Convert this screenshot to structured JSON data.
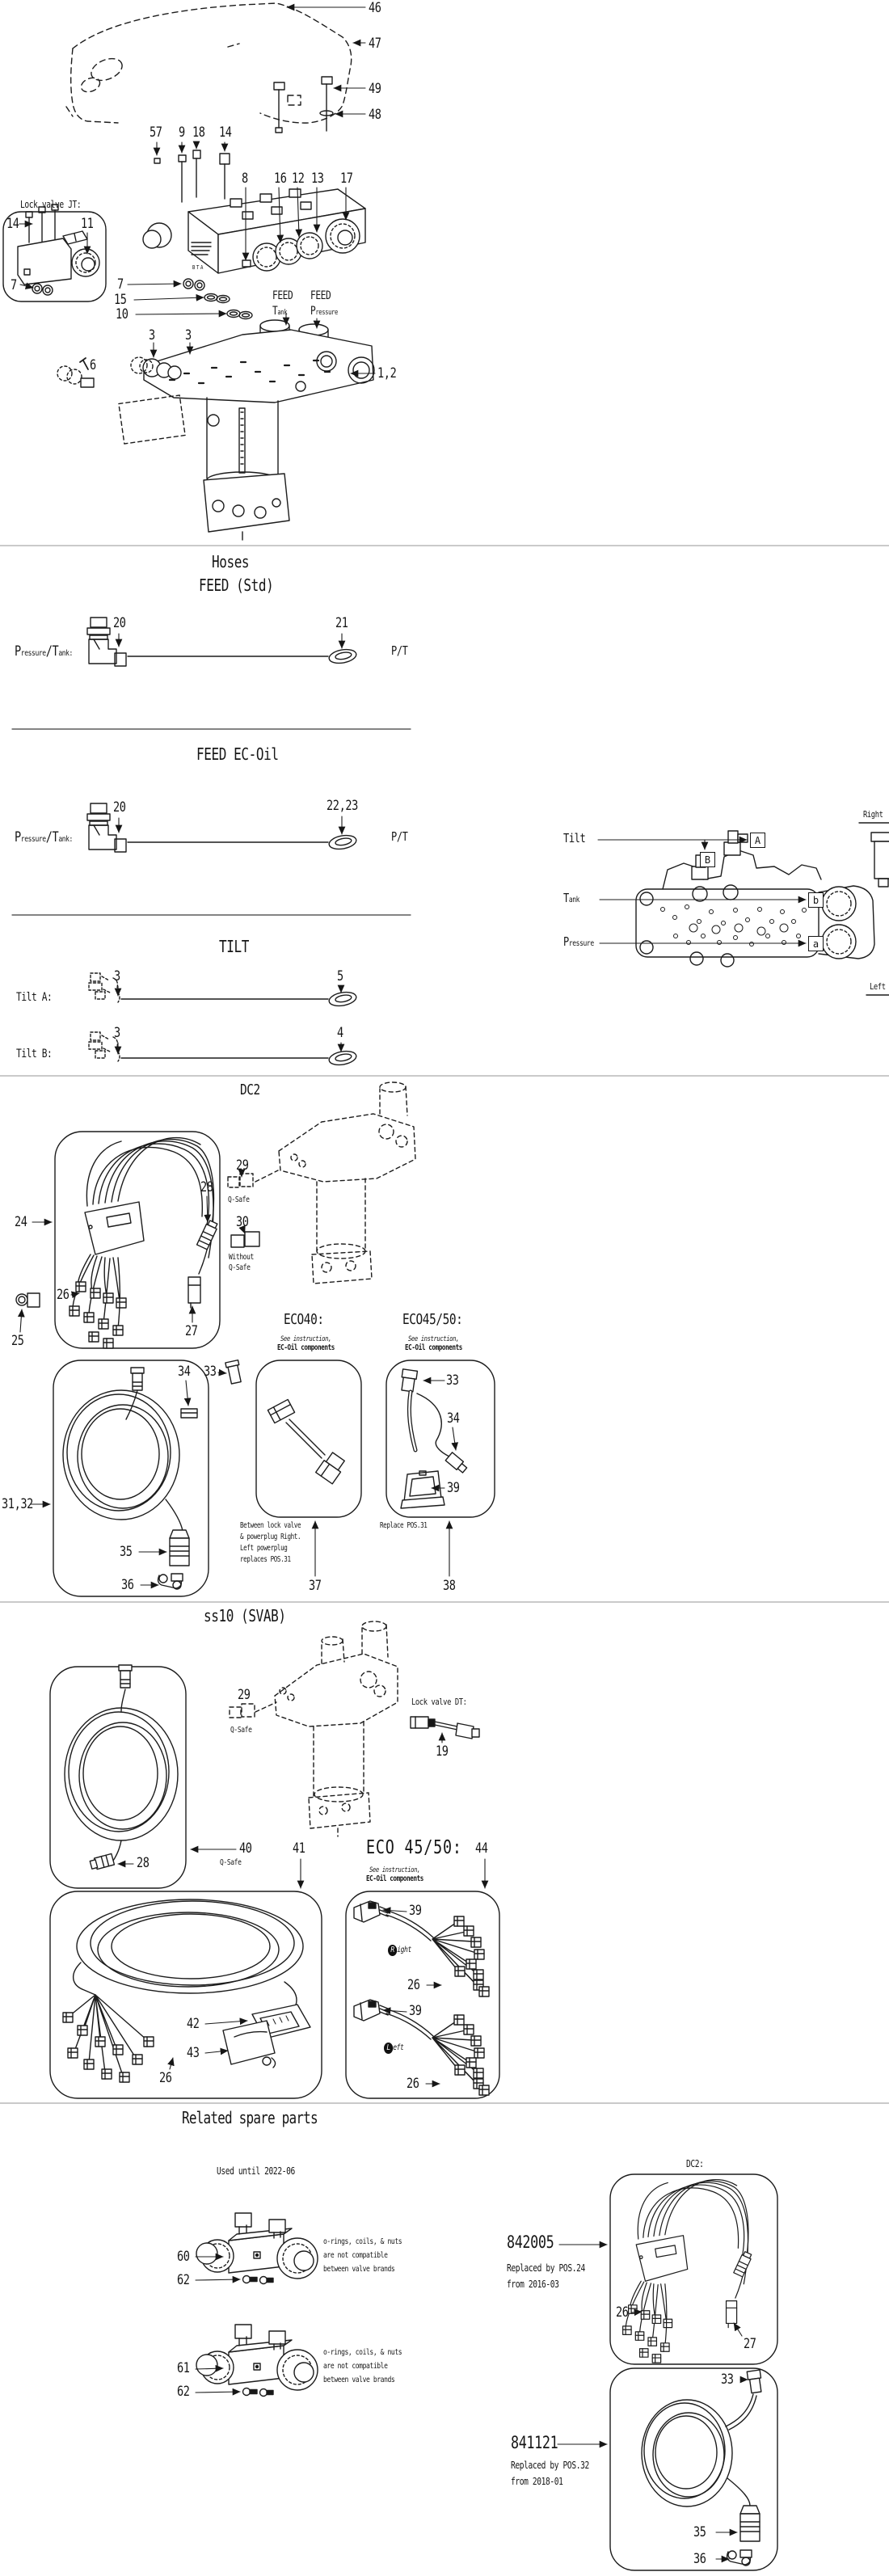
{
  "assembly": {
    "lock_valve_title": "Lock valve JT:",
    "bta": "BTA",
    "feed_tank": {
      "l1": "FEED",
      "big": "T",
      "sub": "ank"
    },
    "feed_pressure": {
      "l1": "FEED",
      "big": "P",
      "sub": "ressure"
    },
    "callouts": {
      "c46": "46",
      "c47": "47",
      "c49": "49",
      "c48": "48",
      "c57": "57",
      "c9": "9",
      "c18": "18",
      "c14": "14",
      "c8": "8",
      "c16": "16",
      "c12": "12",
      "c13": "13",
      "c17": "17",
      "c14b": "14",
      "c11": "11",
      "c7b": "7",
      "c7": "7",
      "c15": "15",
      "c10": "10",
      "c3": "3",
      "c6": "6",
      "c1_2": "1,2"
    }
  },
  "hoses": {
    "title": "Hoses",
    "feed_std": {
      "heading": "FEED (Std)",
      "port": [
        "P",
        "ressure",
        "/T",
        "ank:"
      ],
      "c20": "20",
      "c21": "21",
      "pt": "P/T"
    },
    "feed_ecoil": {
      "heading": "FEED EC-Oil",
      "port": [
        "P",
        "ressure",
        "/T",
        "ank:"
      ],
      "c20": "20",
      "c22_23": "22,23",
      "pt": "P/T"
    },
    "tilt": {
      "heading": "TILT",
      "row_a_label": "Tilt A:",
      "row_a_c3": "3",
      "row_a_c5": "5",
      "row_b_label": "Tilt B:",
      "row_b_c3": "3",
      "row_b_c4": "4"
    }
  },
  "overview": {
    "right": "Right",
    "left": "Left",
    "tilt": "Tilt",
    "tank_big": "T",
    "tank_sub": "ank",
    "pressure_big": "P",
    "pressure_sub": "ressure",
    "port_a": "A",
    "port_b": "B",
    "port_b_small": "b",
    "port_a_small": "a"
  },
  "dc2": {
    "heading": "DC2",
    "c24": "24",
    "c25": "25",
    "c26": "26",
    "c27": "27",
    "c28": "28",
    "c29": "29",
    "q_safe": "Q-Safe",
    "c30": "30",
    "without_q_safe": "Without\nQ-Safe",
    "c31_32": "31,32",
    "c33": "33",
    "c34": "34",
    "c35": "35",
    "c36": "36",
    "eco40": {
      "heading": "ECO40:",
      "see1": "See instruction,",
      "see2": "EC-Oil components",
      "note": "Between lock valve\n& powerplug Right.\nLeft powerplug\nreplaces POS.31",
      "c37": "37"
    },
    "eco4550": {
      "heading": "ECO45/50:",
      "see1": "See instruction,",
      "see2": "EC-Oil components",
      "c33": "33",
      "c34": "34",
      "c39": "39",
      "note": "Replace POS.31",
      "c38": "38"
    }
  },
  "ss10": {
    "heading": "ss10 (SVAB)",
    "c29": "29",
    "q_safe": "Q-Safe",
    "lock_valve_title": "Lock valve DT:",
    "c19": "19",
    "c28": "28",
    "c40": "40",
    "q_safe40": "Q-Safe",
    "c41": "41",
    "eco_heading": "ECO 45/50:",
    "c44": "44",
    "see1": "See instruction,",
    "see2": "EC-Oil components",
    "c42": "42",
    "c43": "43",
    "c26": "26",
    "right_plug": {
      "c39": "39",
      "initial": "R",
      "rest": "ight",
      "c26": "26"
    },
    "left_plug": {
      "c39": "39",
      "initial": "L",
      "rest": "eft",
      "c26": "26"
    }
  },
  "spares": {
    "heading": "Related spare parts",
    "used_until": "Used until 2022-06",
    "c60": "60",
    "c61": "61",
    "c62": "62",
    "compat_note": "o-rings, coils, & nuts\nare not compatible\nbetween valve brands",
    "dc2_label": "DC2:",
    "p842005": {
      "number": "842005",
      "note": "Replaced by POS.24\nfrom 2016-03",
      "c26": "26",
      "c27": "27"
    },
    "p841121": {
      "number": "841121",
      "note": "Replaced by POS.32\nfrom 2018-01",
      "c33": "33",
      "c35": "35",
      "c36": "36"
    }
  }
}
